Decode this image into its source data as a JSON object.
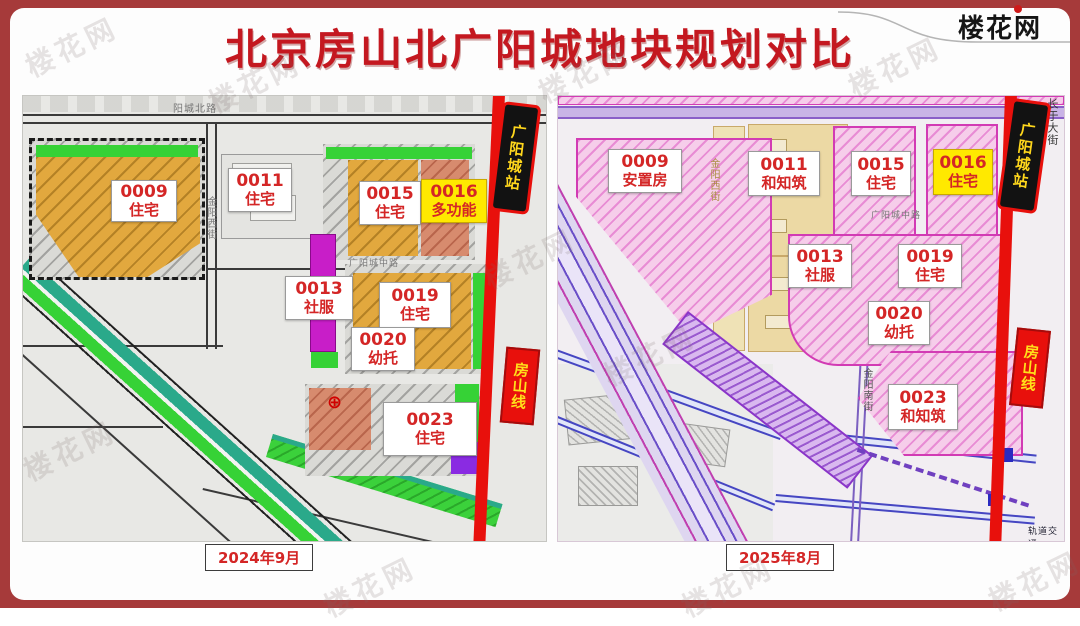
{
  "page": {
    "title": "北京房山北广阳城地块规划对比",
    "logo": "楼花网",
    "watermark": "楼花网"
  },
  "left_map": {
    "date": "2024年9月",
    "metro": {
      "station": "广阳城站",
      "line": "房山线"
    },
    "streets": {
      "north_road": "阳城北路",
      "west_street": "金阳西街",
      "middle_road": "广阳城中路"
    },
    "parcels": [
      {
        "id": "0009",
        "use": "住宅"
      },
      {
        "id": "0011",
        "use": "住宅"
      },
      {
        "id": "0015",
        "use": "住宅"
      },
      {
        "id": "0016",
        "use": "多功能"
      },
      {
        "id": "0013",
        "use": "社服"
      },
      {
        "id": "0019",
        "use": "住宅"
      },
      {
        "id": "0020",
        "use": "幼托"
      },
      {
        "id": "0023",
        "use": "住宅"
      }
    ]
  },
  "right_map": {
    "date": "2025年8月",
    "metro": {
      "station": "广阳城站",
      "line": "房山线"
    },
    "streets": {
      "changyu_street": "长于大街",
      "west_street": "金阳西街",
      "middle_road": "广阳城中路",
      "south_street": "金阳南街",
      "rail_note": "轨道交通"
    },
    "parcels": [
      {
        "id": "0009",
        "use": "安置房"
      },
      {
        "id": "0011",
        "use": "和知筑"
      },
      {
        "id": "0015",
        "use": "住宅"
      },
      {
        "id": "0016",
        "use": "住宅"
      },
      {
        "id": "0013",
        "use": "社服"
      },
      {
        "id": "0019",
        "use": "住宅"
      },
      {
        "id": "0020",
        "use": "幼托"
      },
      {
        "id": "0023",
        "use": "和知筑"
      }
    ]
  },
  "colors": {
    "frame_red": "#a63a3a",
    "title_red": "#c41820",
    "label_red": "#d42626",
    "highlight_yellow": "#ffe900",
    "metro_red": "#e8100c",
    "station_text_yellow": "#ffd71c",
    "residential_gold": "#e2a83e",
    "greenbelt_green": "#36d236",
    "service_magenta": "#c81ec8",
    "planning_pink": "#f6cdea",
    "mixed_salmon": "#d78b6e",
    "tan_block": "#ecd9a4"
  }
}
